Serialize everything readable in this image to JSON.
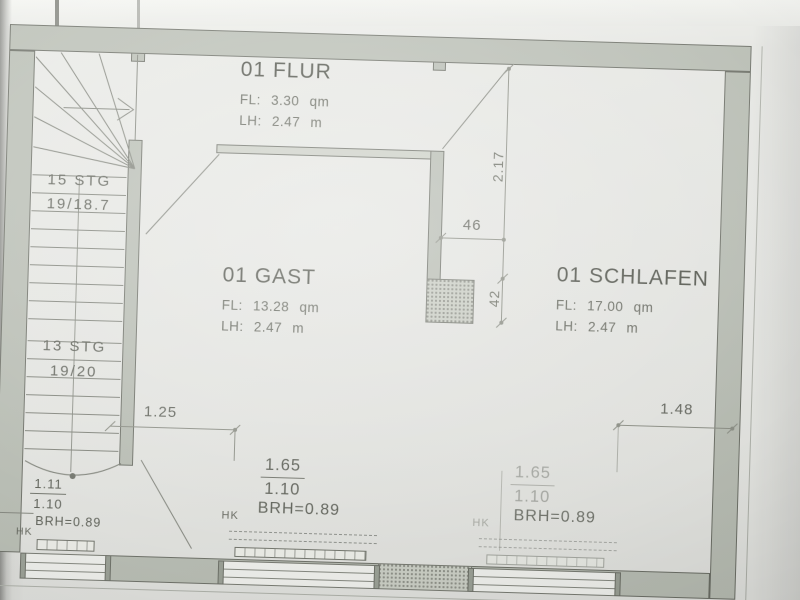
{
  "rooms": [
    {
      "name": "01 FLUR",
      "area": "FL: 3.30 qm",
      "clear_height": "LH: 2.47 m"
    },
    {
      "name": "01 GAST",
      "area": "FL: 13.28 qm",
      "clear_height": "LH: 2.47 m"
    },
    {
      "name": "01 SCHLAFEN",
      "area": "FL: 17.00 qm",
      "clear_height": "LH: 2.47 m"
    }
  ],
  "stairs": {
    "upper": {
      "steps": "15 STG",
      "rise_run": "19/18.7"
    },
    "lower": {
      "steps": "13 STG",
      "rise_run": "19/20"
    }
  },
  "dimensions": {
    "flur_depth": "2.17",
    "niche_width": "46",
    "niche_depth": "42",
    "offset_left": "1.25",
    "offset_right": "1.48"
  },
  "windows": {
    "stair": {
      "width": "1.11",
      "height": "1.10",
      "parapet": "BRH=0.89",
      "radiator": "HK"
    },
    "gast": {
      "width": "1.65",
      "height": "1.10",
      "parapet": "BRH=0.89",
      "radiator": "HK"
    },
    "schlafen": {
      "width": "1.65",
      "height": "1.10",
      "parapet": "BRH=0.89",
      "radiator": "HK"
    }
  },
  "colors": {
    "wall_fill": "#b9beb4",
    "wall_outline": "#6b6e65",
    "line": "#82857c",
    "text": "#54574e",
    "paper": "#ecede9"
  }
}
